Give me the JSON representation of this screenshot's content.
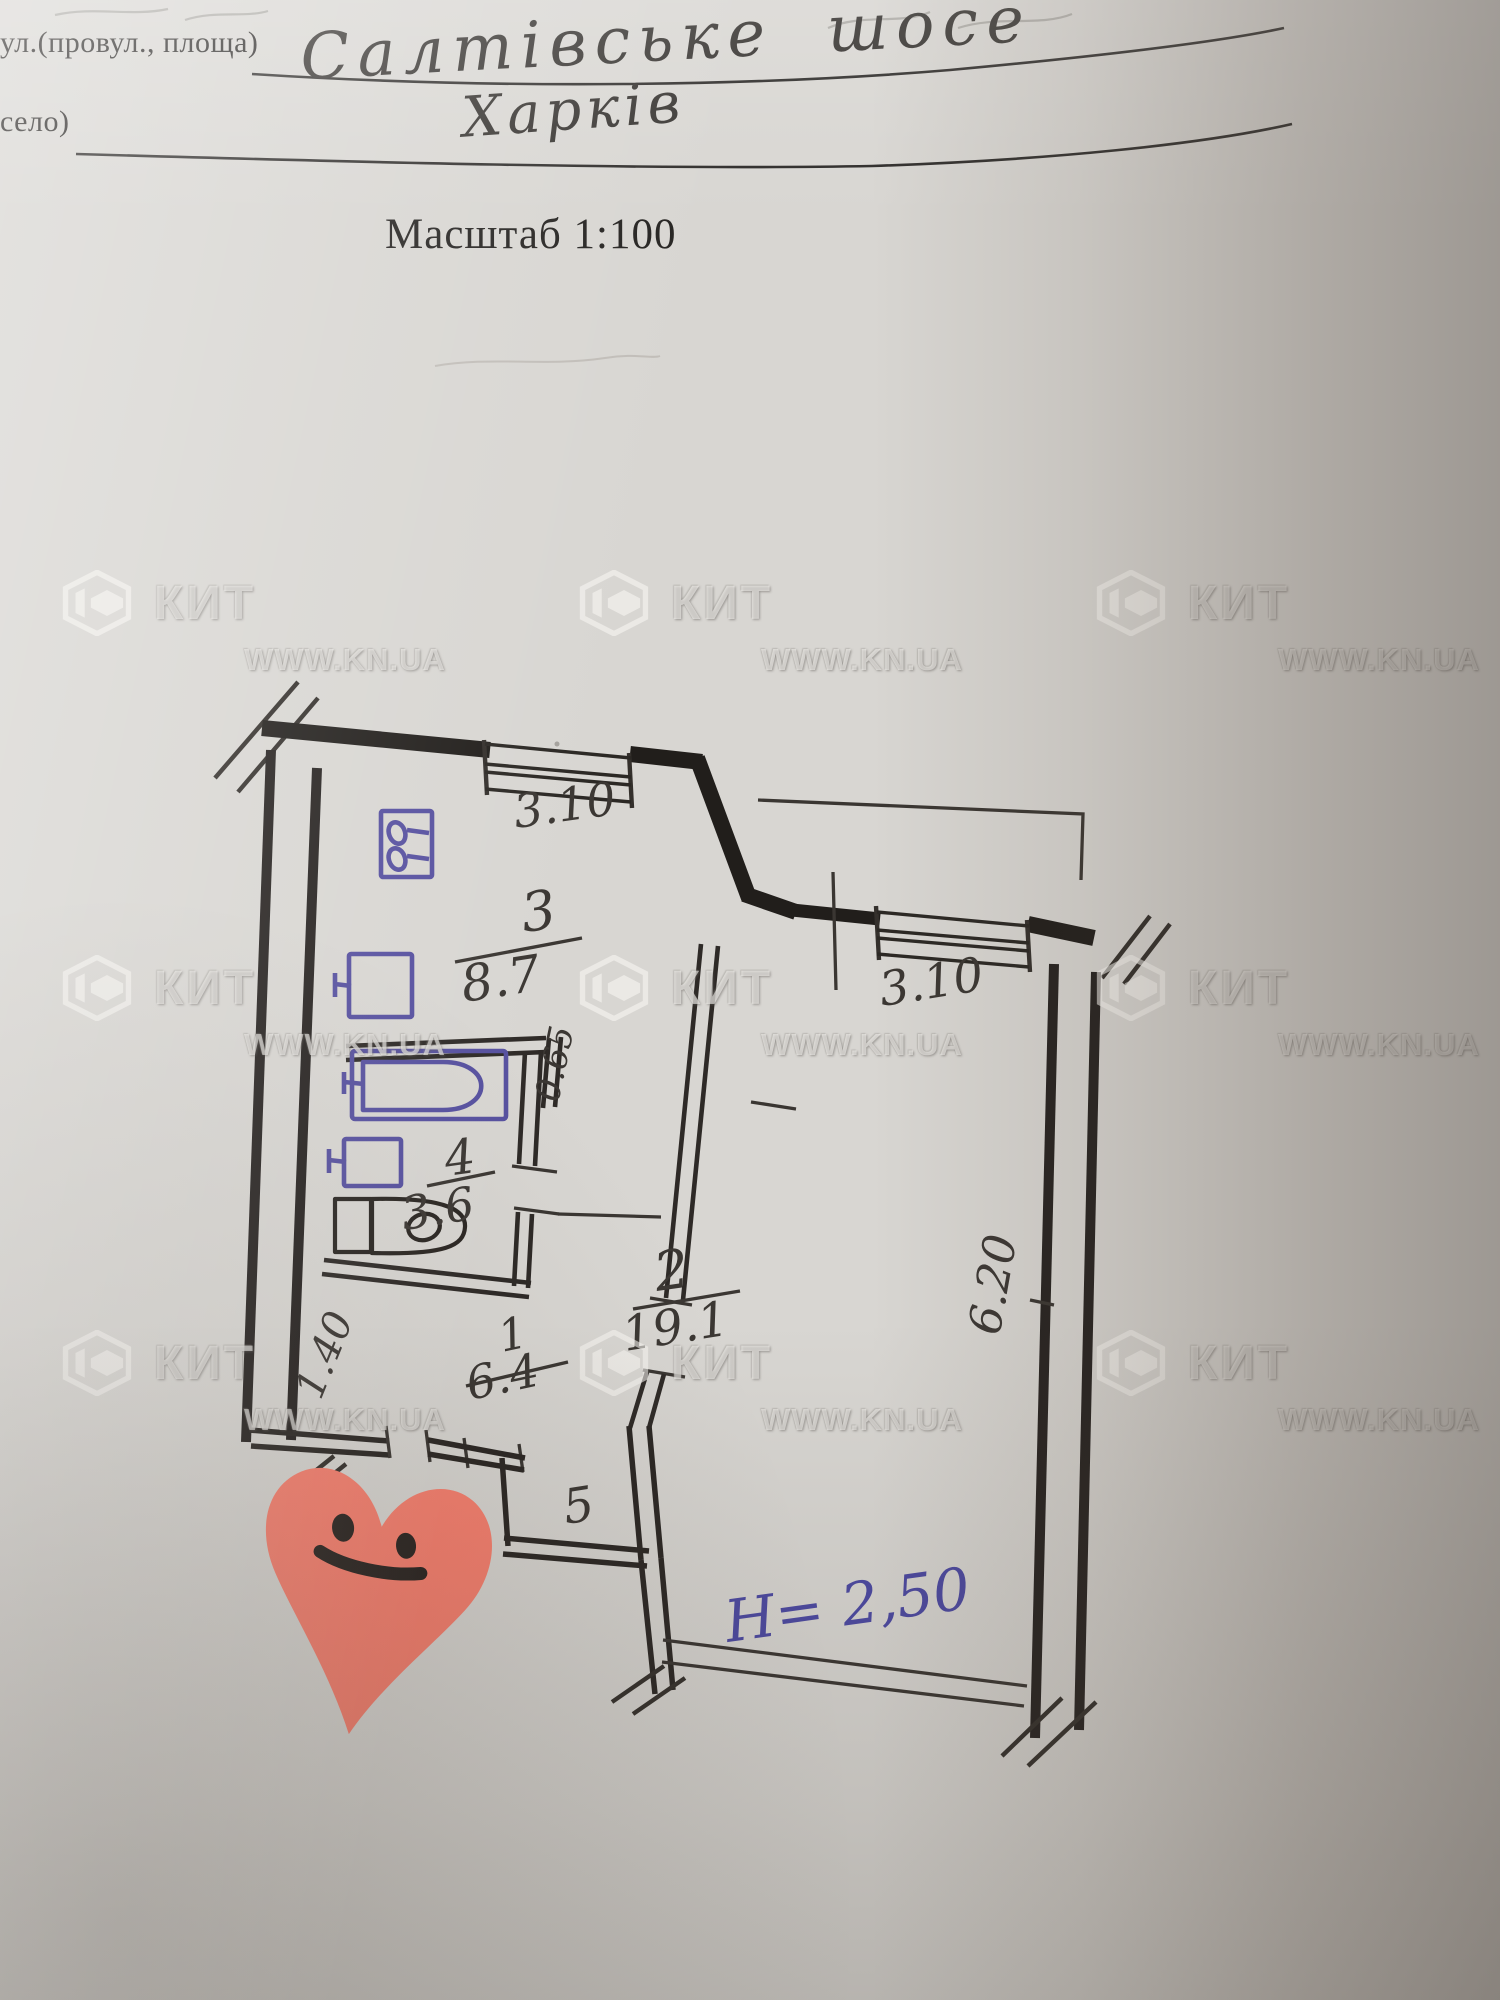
{
  "form": {
    "street_label": "ул.(провул., площа)",
    "street_value": "Салтівське шосе",
    "settlement_label": "село)",
    "settlement_value": "Харків",
    "scale_label": "Масштаб 1:100"
  },
  "watermark": {
    "brand": "КИТ",
    "url": "WWW.KN.UA"
  },
  "plan": {
    "rooms": {
      "kitchen": {
        "number": "3",
        "area": "8.7"
      },
      "bathroom": {
        "number": "4",
        "area": "3.6"
      },
      "hall": {
        "number": "1",
        "area": "6.4"
      },
      "living_room": {
        "number": "2",
        "area": "19.1"
      },
      "closet": {
        "number": "5"
      }
    },
    "dimensions": {
      "kitchen_window": "3.10",
      "living_room_window": "3.10",
      "living_room_depth": "6.20",
      "kitchen_niche": "0.65",
      "hall_width": "1.40",
      "ceiling_height": "H= 2,50"
    }
  },
  "sticker": {
    "shape": "heart",
    "face": "smiley"
  },
  "colors": {
    "pencil_ink": "#3b3733",
    "fixture_ink": "#56509f",
    "blue_ink": "#4c49a2",
    "heart": "#f8806f"
  }
}
